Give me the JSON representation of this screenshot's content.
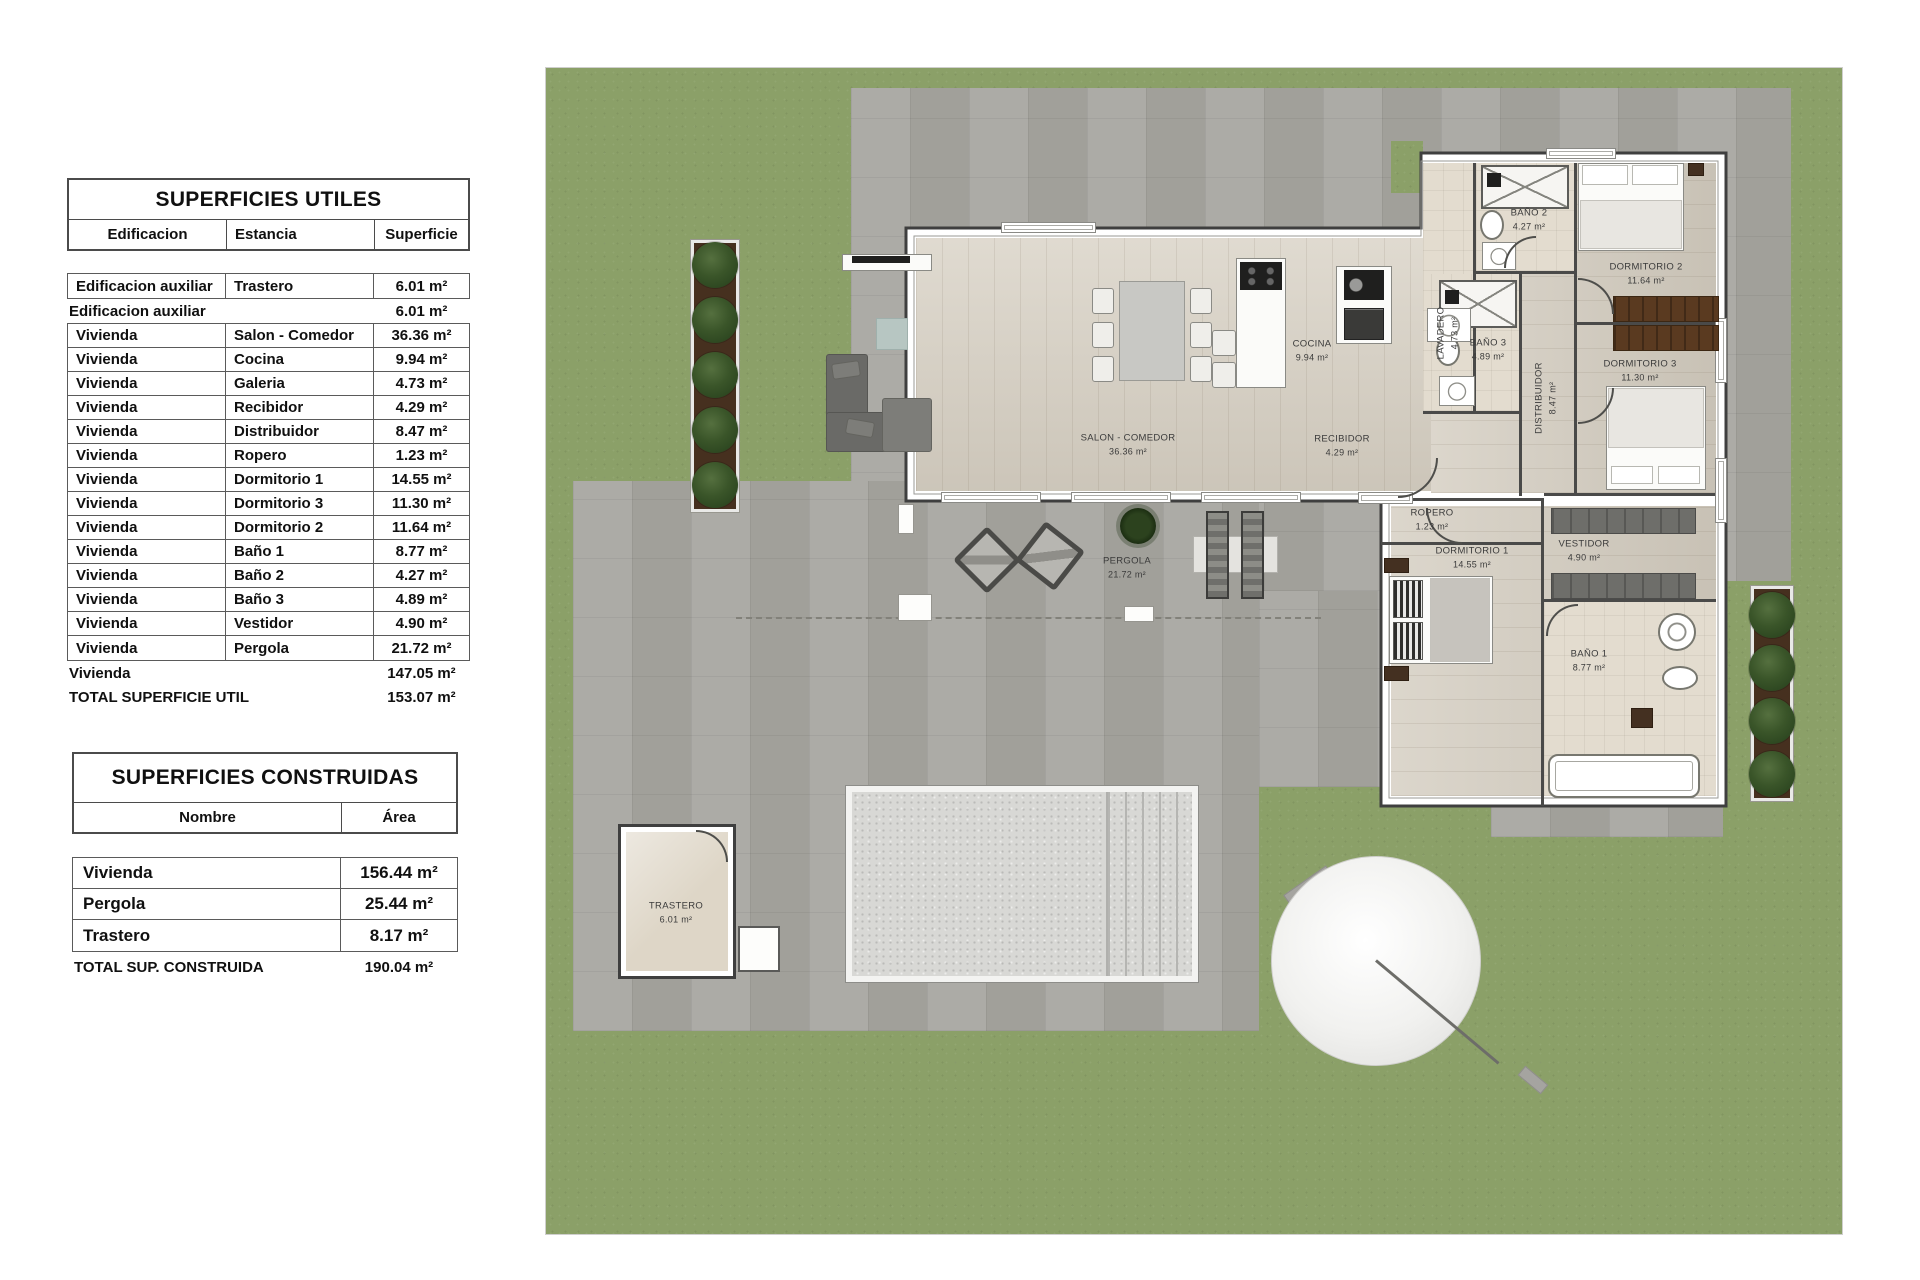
{
  "tables": {
    "utiles": {
      "title": "SUPERFICIES UTILES",
      "col_edificacion": "Edificacion",
      "col_estancia": "Estancia",
      "col_superficie": "Superficie",
      "rows": [
        {
          "edificacion": "Edificacion auxiliar",
          "estancia": "Trastero",
          "superficie": "6.01 m²"
        },
        {
          "edificacion": "Vivienda",
          "estancia": "Salon - Comedor",
          "superficie": "36.36 m²"
        },
        {
          "edificacion": "Vivienda",
          "estancia": "Cocina",
          "superficie": "9.94 m²"
        },
        {
          "edificacion": "Vivienda",
          "estancia": "Galeria",
          "superficie": "4.73 m²"
        },
        {
          "edificacion": "Vivienda",
          "estancia": "Recibidor",
          "superficie": "4.29 m²"
        },
        {
          "edificacion": "Vivienda",
          "estancia": "Distribuidor",
          "superficie": "8.47 m²"
        },
        {
          "edificacion": "Vivienda",
          "estancia": "Ropero",
          "superficie": "1.23 m²"
        },
        {
          "edificacion": "Vivienda",
          "estancia": "Dormitorio 1",
          "superficie": "14.55 m²"
        },
        {
          "edificacion": "Vivienda",
          "estancia": "Dormitorio 3",
          "superficie": "11.30 m²"
        },
        {
          "edificacion": "Vivienda",
          "estancia": "Dormitorio 2",
          "superficie": "11.64 m²"
        },
        {
          "edificacion": "Vivienda",
          "estancia": "Baño 1",
          "superficie": "8.77 m²"
        },
        {
          "edificacion": "Vivienda",
          "estancia": "Baño 2",
          "superficie": "4.27 m²"
        },
        {
          "edificacion": "Vivienda",
          "estancia": "Baño 3",
          "superficie": "4.89 m²"
        },
        {
          "edificacion": "Vivienda",
          "estancia": "Vestidor",
          "superficie": "4.90 m²"
        },
        {
          "edificacion": "Vivienda",
          "estancia": "Pergola",
          "superficie": "21.72 m²"
        }
      ],
      "subtotal_aux": {
        "label": "Edificacion auxiliar",
        "value": "6.01 m²"
      },
      "subtotal_vivienda": {
        "label": "Vivienda",
        "value": "147.05 m²"
      },
      "total": {
        "label": "TOTAL SUPERFICIE UTIL",
        "value": "153.07 m²"
      }
    },
    "construidas": {
      "title": "SUPERFICIES CONSTRUIDAS",
      "col_nombre": "Nombre",
      "col_area": "Área",
      "rows": [
        {
          "nombre": "Vivienda",
          "area": "156.44 m²"
        },
        {
          "nombre": "Pergola",
          "area": "25.44 m²"
        },
        {
          "nombre": "Trastero",
          "area": "8.17 m²"
        }
      ],
      "total": {
        "label": "TOTAL SUP. CONSTRUIDA",
        "value": "190.04 m²"
      }
    }
  },
  "plan": {
    "rooms": [
      {
        "name": "SALON - COMEDOR",
        "area": "36.36 m²"
      },
      {
        "name": "COCINA",
        "area": "9.94 m²"
      },
      {
        "name": "LAVADERO",
        "area": "4.73 m²"
      },
      {
        "name": "RECIBIDOR",
        "area": "4.29 m²"
      },
      {
        "name": "BAÑO 2",
        "area": "4.27 m²"
      },
      {
        "name": "DORMITORIO 2",
        "area": "11.64 m²"
      },
      {
        "name": "BAÑO 3",
        "area": "4.89 m²"
      },
      {
        "name": "DISTRIBUIDOR",
        "area": "8.47 m²"
      },
      {
        "name": "DORMITORIO 3",
        "area": "11.30 m²"
      },
      {
        "name": "ROPERO",
        "area": "1.23 m²"
      },
      {
        "name": "DORMITORIO 1",
        "area": "14.55 m²"
      },
      {
        "name": "VESTIDOR",
        "area": "4.90 m²"
      },
      {
        "name": "BAÑO 1",
        "area": "8.77 m²"
      },
      {
        "name": "PERGOLA",
        "area": "21.72 m²"
      },
      {
        "name": "TRASTERO",
        "area": "6.01 m²"
      }
    ]
  },
  "colors": {
    "grass": "#8ba068",
    "paving": "#a8a7a1",
    "wood_floor": "#d7d0c3",
    "wall_line": "#3f3f3f",
    "wardrobe_brown": "#5a3a20",
    "tree_green": "#3a5529",
    "pool": "#d8d8d5"
  }
}
